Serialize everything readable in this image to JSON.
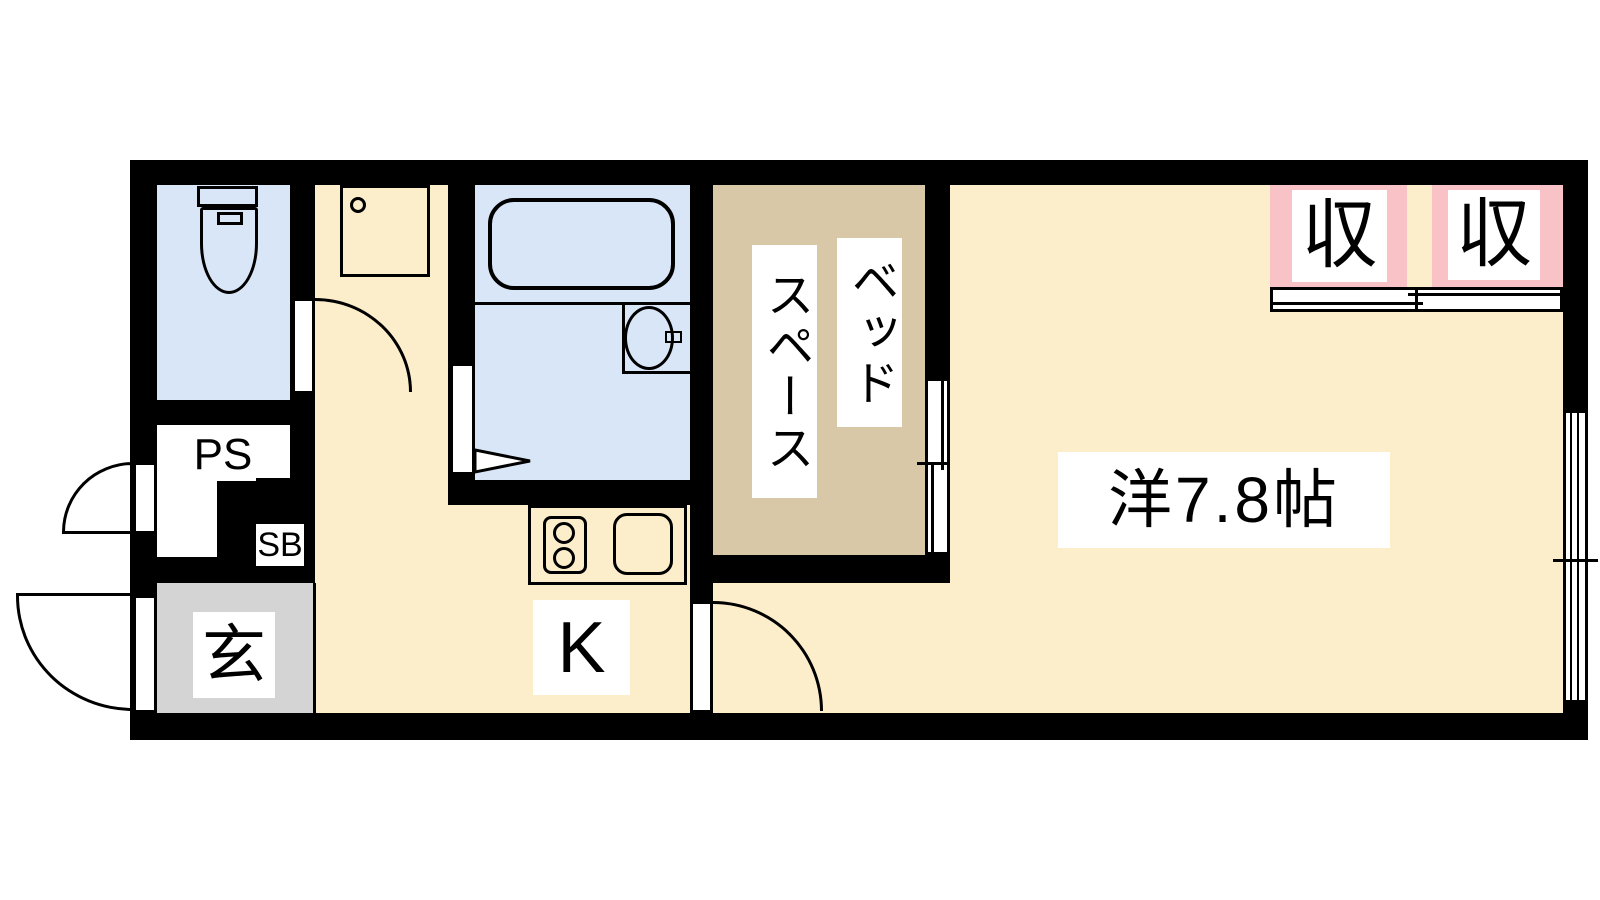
{
  "plan": {
    "labels": {
      "pipe_space": "PS",
      "shoe_box": "SB",
      "entrance": "玄",
      "kitchen": "K",
      "bed_space_line1": "ベッド",
      "bed_space_line2": "スペース",
      "main_room": "洋7.8帖",
      "closet_left": "収",
      "closet_right": "収"
    },
    "colors": {
      "wall": "#000000",
      "bg": "#FFFFFF",
      "floor": "#FCEECB",
      "wet": "#D9E6F7",
      "bed": "#D9C8A8",
      "closet": "#F9C2C6",
      "counter": "#E7DAF2",
      "entry": "#D4D4D4"
    }
  }
}
